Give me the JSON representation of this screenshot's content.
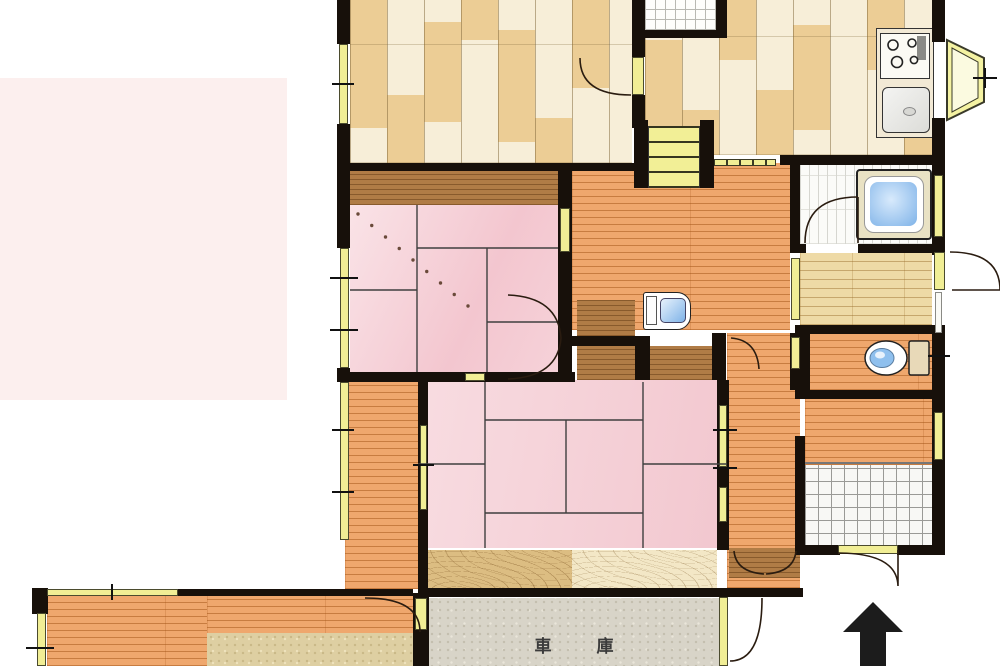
{
  "labels": {
    "garage": "車庫"
  },
  "compass": {
    "icon": "north-arrow",
    "direction": "up"
  },
  "fixtures": {
    "kitchen": [
      "stove-icon",
      "sink-icon"
    ],
    "bathroom": "bathtub-icon",
    "toilet_room": "toilet-icon",
    "hallway": "washbasin-icon"
  },
  "colors": {
    "wall": "#17100a",
    "tatami_pink": "#f3c6cf",
    "hall_wood": "#efa76d",
    "room_wood": "#f7eed8",
    "accent_plank": "#eac98e",
    "window_yellow": "#f1ee95",
    "water_blue": "#7fb3e8",
    "garage_floor": "#d8d4c8",
    "overlay_pink": "#fcefee"
  }
}
